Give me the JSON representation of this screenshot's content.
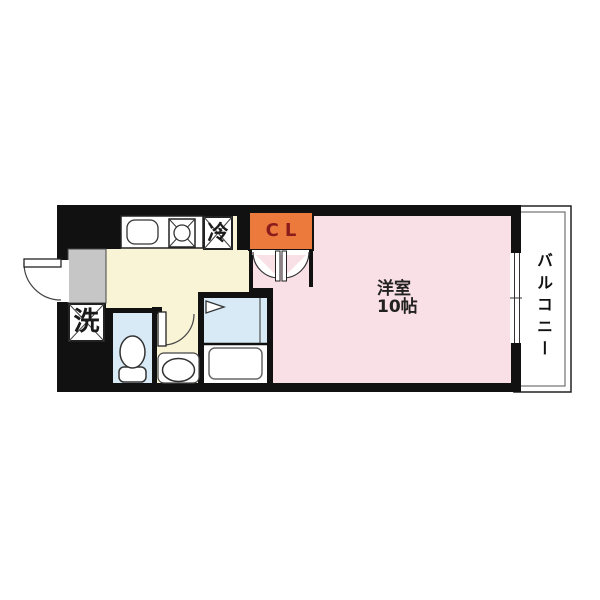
{
  "floor_plan": {
    "type": "japanese-apartment-floor-plan",
    "rooms": {
      "main_room": {
        "label_line1": "洋室",
        "label_line2": "10帖",
        "floor_color": "#F9DFE6"
      },
      "kitchen": {
        "floor_color": "#F9F4D6"
      },
      "balcony": {
        "label": "バルコニー"
      },
      "closet": {
        "label": "CL",
        "bg_color": "#EC7A3D",
        "text_color": "#8B1C1C"
      },
      "refrigerator_space": {
        "label": "冷"
      },
      "washer_space": {
        "label": "洗"
      },
      "toilet_room": {
        "floor_color": "#D8EAF5"
      },
      "bathroom": {
        "floor_color": "#D8EAF5"
      },
      "entrance": {
        "floor_color": "#C6C6C6"
      }
    },
    "fixtures": [
      "kitchen-sink-icon",
      "gas-stove-icon",
      "toilet-icon",
      "bathtub-icon",
      "shower-icon",
      "wash-basin-icon",
      "entrance-door-swing-icon",
      "toilet-door-swing-icon",
      "closet-double-door-icon",
      "sliding-window-icon"
    ],
    "colors": {
      "wall": "#111111",
      "outline": "#222222",
      "background": "#ffffff"
    }
  }
}
